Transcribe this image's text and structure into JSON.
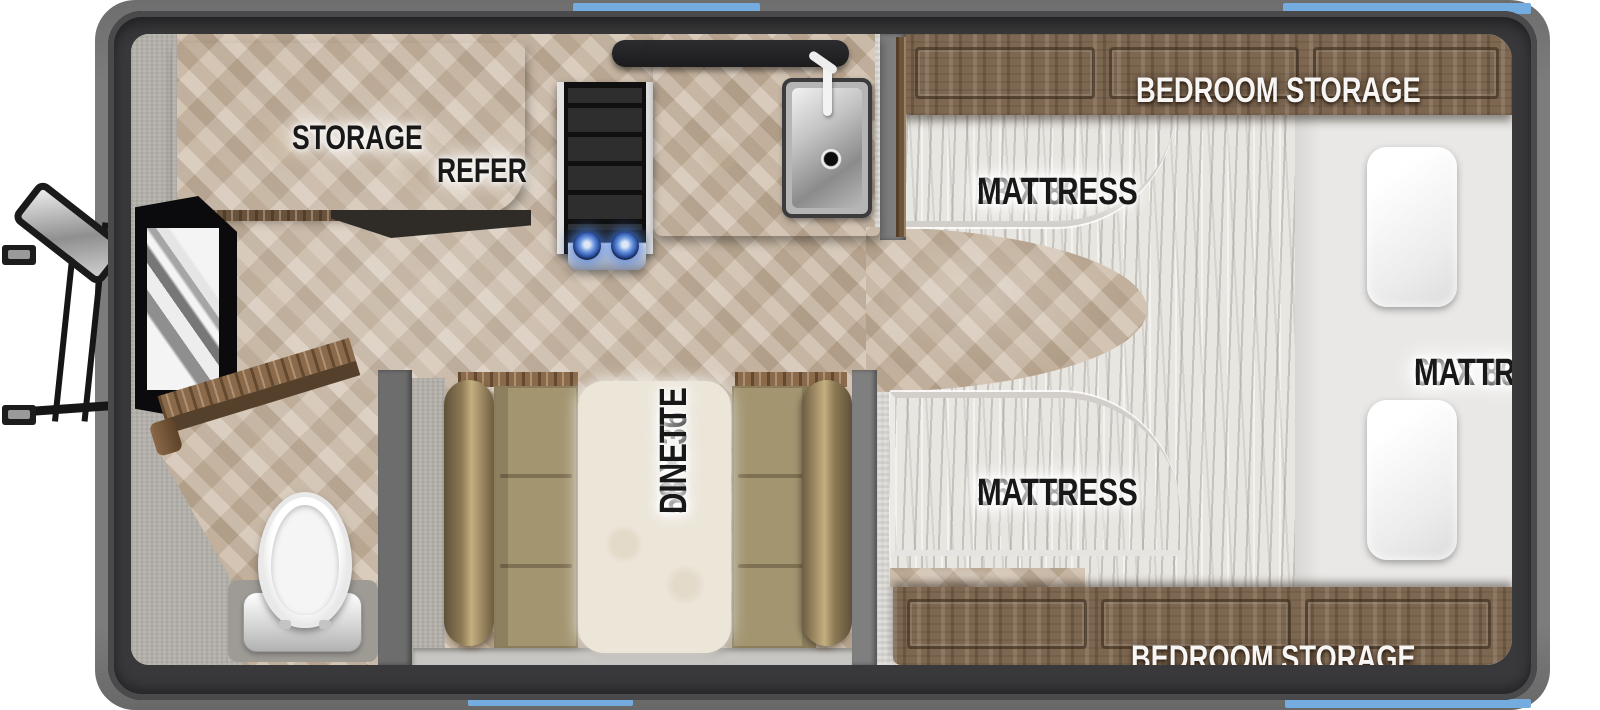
{
  "title": "Truck camper floor plan",
  "labels": {
    "storage": "STORAGE",
    "refer": "REFER",
    "bedroom_storage_top": "BEDROOM STORAGE",
    "bedroom_storage_bottom": "BEDROOM STORAGE",
    "mattress_23": {
      "size": "23 X 80",
      "word": "MATTRESS"
    },
    "mattress_36": {
      "size": "36 X 80",
      "word": "MATTRESS"
    },
    "mattress_60": {
      "size": "60 X 80",
      "word": "MATTRESS"
    },
    "dinette": {
      "size": "58 X 36",
      "word": "DINETTE"
    }
  },
  "colors": {
    "accent_blue": "#74acdf",
    "shell_dark": "#39393b",
    "exterior_gray": "#7c7c7c",
    "wood_cabinet": "#7d6750",
    "floor_beige": "#c9b7a2",
    "counter_cream": "#e4ded1",
    "comforter_white": "#e8e6e1",
    "cushion_tan": "#a39570",
    "burner_blue": "#2c52a8",
    "label_black": "#181818",
    "label_white": "#f7f6f4"
  }
}
